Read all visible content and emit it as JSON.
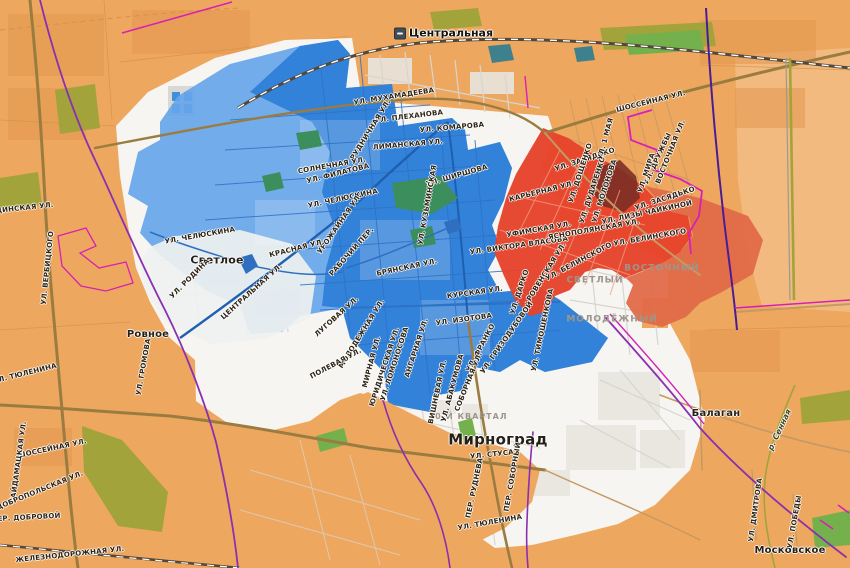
{
  "colors": {
    "field": "#eea75f",
    "field-dark": "#e3974e",
    "field-light": "#f3c08a",
    "field-line": "#d69149",
    "city": "#f6f5f1",
    "city-block": "#e8e6df",
    "zone-blue": "#66a5ea",
    "zone-blue-core": "#2f7fd8",
    "zone-red": "#e6432a",
    "zone-red-light": "#e06a48",
    "zone-dark-red": "#7c2f26",
    "water": "#2e6fc0",
    "pond-teal": "#3e808c",
    "park": "#74b14c",
    "park-blue": "#3c8f5d",
    "olive": "#a3a33c",
    "road": "#9b7c40",
    "road-minor": "#c49a62",
    "street-white": "#d8d5ce",
    "street-blue": "#2d72c6",
    "street-red": "#f29b82",
    "street-orange": "#cf9a60",
    "railway": "#55483a",
    "boundary-purple": "#8b2fb0",
    "boundary-indigo": "#4a1d96",
    "boundary-magenta": "#d621b4",
    "label": "#2e2414",
    "label-place": "#241f17",
    "label-hood": "#9c968c",
    "label-water": "#3c441e"
  },
  "station": {
    "label": "Центральная"
  },
  "labels": [
    {
      "t": "Светлое",
      "x": 217,
      "y": 260,
      "r": 0,
      "k": "place"
    },
    {
      "t": "Ровное",
      "x": 148,
      "y": 335,
      "r": 0,
      "k": "place",
      "s": 10
    },
    {
      "t": "Мирноград",
      "x": 498,
      "y": 440,
      "r": 0,
      "k": "place",
      "s": 15
    },
    {
      "t": "Балаган",
      "x": 716,
      "y": 414,
      "r": 0,
      "k": "place",
      "s": 10
    },
    {
      "t": "Московское",
      "x": 790,
      "y": 551,
      "r": 0,
      "k": "place",
      "s": 10
    },
    {
      "t": "Светлый",
      "x": 595,
      "y": 281,
      "r": 0,
      "k": "hood"
    },
    {
      "t": "Молодёжный",
      "x": 612,
      "y": 320,
      "r": 0,
      "k": "hood"
    },
    {
      "t": "Восточный",
      "x": 662,
      "y": 269,
      "r": 0,
      "k": "hood"
    },
    {
      "t": "40-й квартал",
      "x": 468,
      "y": 417,
      "r": 0,
      "k": "hood",
      "s": 8
    },
    {
      "t": "р. Сенная",
      "x": 780,
      "y": 430,
      "r": -65,
      "k": "water",
      "s": 8
    },
    {
      "t": "ул. Мухамадеева",
      "x": 394,
      "y": 97,
      "r": -9,
      "k": "street"
    },
    {
      "t": "ул. Плеханова",
      "x": 409,
      "y": 117,
      "r": -7,
      "k": "street"
    },
    {
      "t": "ул. Комарова",
      "x": 452,
      "y": 128,
      "r": -5,
      "k": "street"
    },
    {
      "t": "Лиманская ул.",
      "x": 408,
      "y": 145,
      "r": -5,
      "k": "street"
    },
    {
      "t": "Рудничная ул.",
      "x": 371,
      "y": 130,
      "r": -58,
      "k": "street"
    },
    {
      "t": "Солнечная ул.",
      "x": 332,
      "y": 166,
      "r": -10,
      "k": "street"
    },
    {
      "t": "ул. Филатова",
      "x": 338,
      "y": 174,
      "r": -14,
      "k": "street"
    },
    {
      "t": "ул. Челюскина",
      "x": 343,
      "y": 199,
      "r": -12,
      "k": "street"
    },
    {
      "t": "ул. Ширшова",
      "x": 457,
      "y": 176,
      "r": -16,
      "k": "street"
    },
    {
      "t": "ул. Кузьминская",
      "x": 428,
      "y": 205,
      "r": -80,
      "k": "street"
    },
    {
      "t": "ул. Челюскина",
      "x": 200,
      "y": 236,
      "r": -10,
      "k": "street"
    },
    {
      "t": "Урожайная ул.",
      "x": 340,
      "y": 224,
      "r": -55,
      "k": "street"
    },
    {
      "t": "Красная ул.",
      "x": 297,
      "y": 249,
      "r": -14,
      "k": "street"
    },
    {
      "t": "Рабочий пер.",
      "x": 352,
      "y": 252,
      "r": -48,
      "k": "street"
    },
    {
      "t": "ул. Родина",
      "x": 190,
      "y": 279,
      "r": -45,
      "k": "street"
    },
    {
      "t": "Центральная ул.",
      "x": 252,
      "y": 292,
      "r": -42,
      "k": "street"
    },
    {
      "t": "Брянская ул.",
      "x": 407,
      "y": 268,
      "r": -12,
      "k": "street"
    },
    {
      "t": "Курская ул.",
      "x": 475,
      "y": 293,
      "r": -8,
      "k": "street"
    },
    {
      "t": "Луговая ул.",
      "x": 337,
      "y": 317,
      "r": -42,
      "k": "street"
    },
    {
      "t": "Молодежная ул.",
      "x": 362,
      "y": 334,
      "r": -58,
      "k": "street"
    },
    {
      "t": "Мирная ул.",
      "x": 372,
      "y": 362,
      "r": -75,
      "k": "street"
    },
    {
      "t": "Юридическая ул.",
      "x": 385,
      "y": 367,
      "r": -72,
      "k": "street"
    },
    {
      "t": "ул. Ломоносова",
      "x": 395,
      "y": 364,
      "r": -72,
      "k": "street"
    },
    {
      "t": "Ангарная ул.",
      "x": 417,
      "y": 348,
      "r": -72,
      "k": "street"
    },
    {
      "t": "Полевая ул.",
      "x": 336,
      "y": 364,
      "r": -28,
      "k": "street"
    },
    {
      "t": "ул. Изотова",
      "x": 464,
      "y": 320,
      "r": -8,
      "k": "street"
    },
    {
      "t": "ул. Гризодубовой",
      "x": 507,
      "y": 338,
      "r": -55,
      "k": "street"
    },
    {
      "t": "ул. Франко",
      "x": 481,
      "y": 348,
      "r": -62,
      "k": "street"
    },
    {
      "t": "Соборная ул.",
      "x": 469,
      "y": 382,
      "r": -68,
      "k": "street"
    },
    {
      "t": "Вишневая ул.",
      "x": 438,
      "y": 392,
      "r": -78,
      "k": "street"
    },
    {
      "t": "ул. Абакумова",
      "x": 453,
      "y": 388,
      "r": -75,
      "k": "street"
    },
    {
      "t": "ул. Стуса",
      "x": 492,
      "y": 455,
      "r": -6,
      "k": "street"
    },
    {
      "t": "пер. Руднева",
      "x": 475,
      "y": 488,
      "r": -78,
      "k": "street"
    },
    {
      "t": "пер. Соборный",
      "x": 513,
      "y": 477,
      "r": -80,
      "k": "street"
    },
    {
      "t": "ул. Тюленина",
      "x": 490,
      "y": 523,
      "r": -10,
      "k": "street"
    },
    {
      "t": "ул. Виктора Власова",
      "x": 519,
      "y": 246,
      "r": -8,
      "k": "street"
    },
    {
      "t": "Уфимская ул.",
      "x": 539,
      "y": 230,
      "r": -10,
      "k": "street"
    },
    {
      "t": "Ровенская ул.",
      "x": 547,
      "y": 272,
      "r": -58,
      "k": "street"
    },
    {
      "t": "ул. Дарко",
      "x": 520,
      "y": 292,
      "r": -72,
      "k": "street"
    },
    {
      "t": "ул. Тимошенкова",
      "x": 543,
      "y": 330,
      "r": -78,
      "k": "street"
    },
    {
      "t": "ул. Белинского",
      "x": 579,
      "y": 262,
      "r": -28,
      "k": "street"
    },
    {
      "t": "Яснополянская ул.",
      "x": 594,
      "y": 230,
      "r": -10,
      "k": "street"
    },
    {
      "t": "ул. Белинского",
      "x": 650,
      "y": 238,
      "r": -10,
      "k": "street"
    },
    {
      "t": "ул. Лизы Чайкиной",
      "x": 647,
      "y": 213,
      "r": -12,
      "k": "street"
    },
    {
      "t": "Карьерная ул.",
      "x": 542,
      "y": 192,
      "r": -14,
      "k": "street"
    },
    {
      "t": "ул. Засядько",
      "x": 585,
      "y": 160,
      "r": -18,
      "k": "street"
    },
    {
      "t": "ул. Засядько",
      "x": 665,
      "y": 199,
      "r": -18,
      "k": "street"
    },
    {
      "t": "ул. Дощенко",
      "x": 581,
      "y": 173,
      "r": -72,
      "k": "street"
    },
    {
      "t": "ул. Дударенко",
      "x": 593,
      "y": 190,
      "r": -72,
      "k": "street"
    },
    {
      "t": "ул. Молонова",
      "x": 605,
      "y": 191,
      "r": -72,
      "k": "street"
    },
    {
      "t": "ул. 1 Мая",
      "x": 606,
      "y": 139,
      "r": -75,
      "k": "street"
    },
    {
      "t": "ул. Дружбы",
      "x": 658,
      "y": 159,
      "r": -65,
      "k": "street"
    },
    {
      "t": "Восточная ул.",
      "x": 671,
      "y": 152,
      "r": -68,
      "k": "street"
    },
    {
      "t": "ул. Мира",
      "x": 647,
      "y": 173,
      "r": -72,
      "k": "street"
    },
    {
      "t": "Шоссейная ул.",
      "x": 651,
      "y": 102,
      "r": -14,
      "k": "street"
    },
    {
      "t": "ул. Тюленина",
      "x": 25,
      "y": 374,
      "r": -14,
      "k": "street"
    },
    {
      "t": "ул. Громова",
      "x": 144,
      "y": 367,
      "r": -80,
      "k": "street"
    },
    {
      "t": "Шоссейная ул.",
      "x": 52,
      "y": 449,
      "r": -12,
      "k": "street"
    },
    {
      "t": "Гайдамацкая ул.",
      "x": 19,
      "y": 462,
      "r": -82,
      "k": "street"
    },
    {
      "t": "Добропольская ул.",
      "x": 40,
      "y": 491,
      "r": -22,
      "k": "street"
    },
    {
      "t": "пер. Добровой",
      "x": 26,
      "y": 518,
      "r": -3,
      "k": "street"
    },
    {
      "t": "Железнодорожная ул.",
      "x": 70,
      "y": 555,
      "r": -6,
      "k": "street"
    },
    {
      "t": "Родинская ул.",
      "x": 19,
      "y": 209,
      "r": -6,
      "k": "street"
    },
    {
      "t": "ул. Вербицкого",
      "x": 48,
      "y": 268,
      "r": -84,
      "k": "street"
    },
    {
      "t": "ул. Дмитрова",
      "x": 756,
      "y": 510,
      "r": -82,
      "k": "street"
    },
    {
      "t": "ул. Победы",
      "x": 795,
      "y": 522,
      "r": -80,
      "k": "street"
    }
  ]
}
